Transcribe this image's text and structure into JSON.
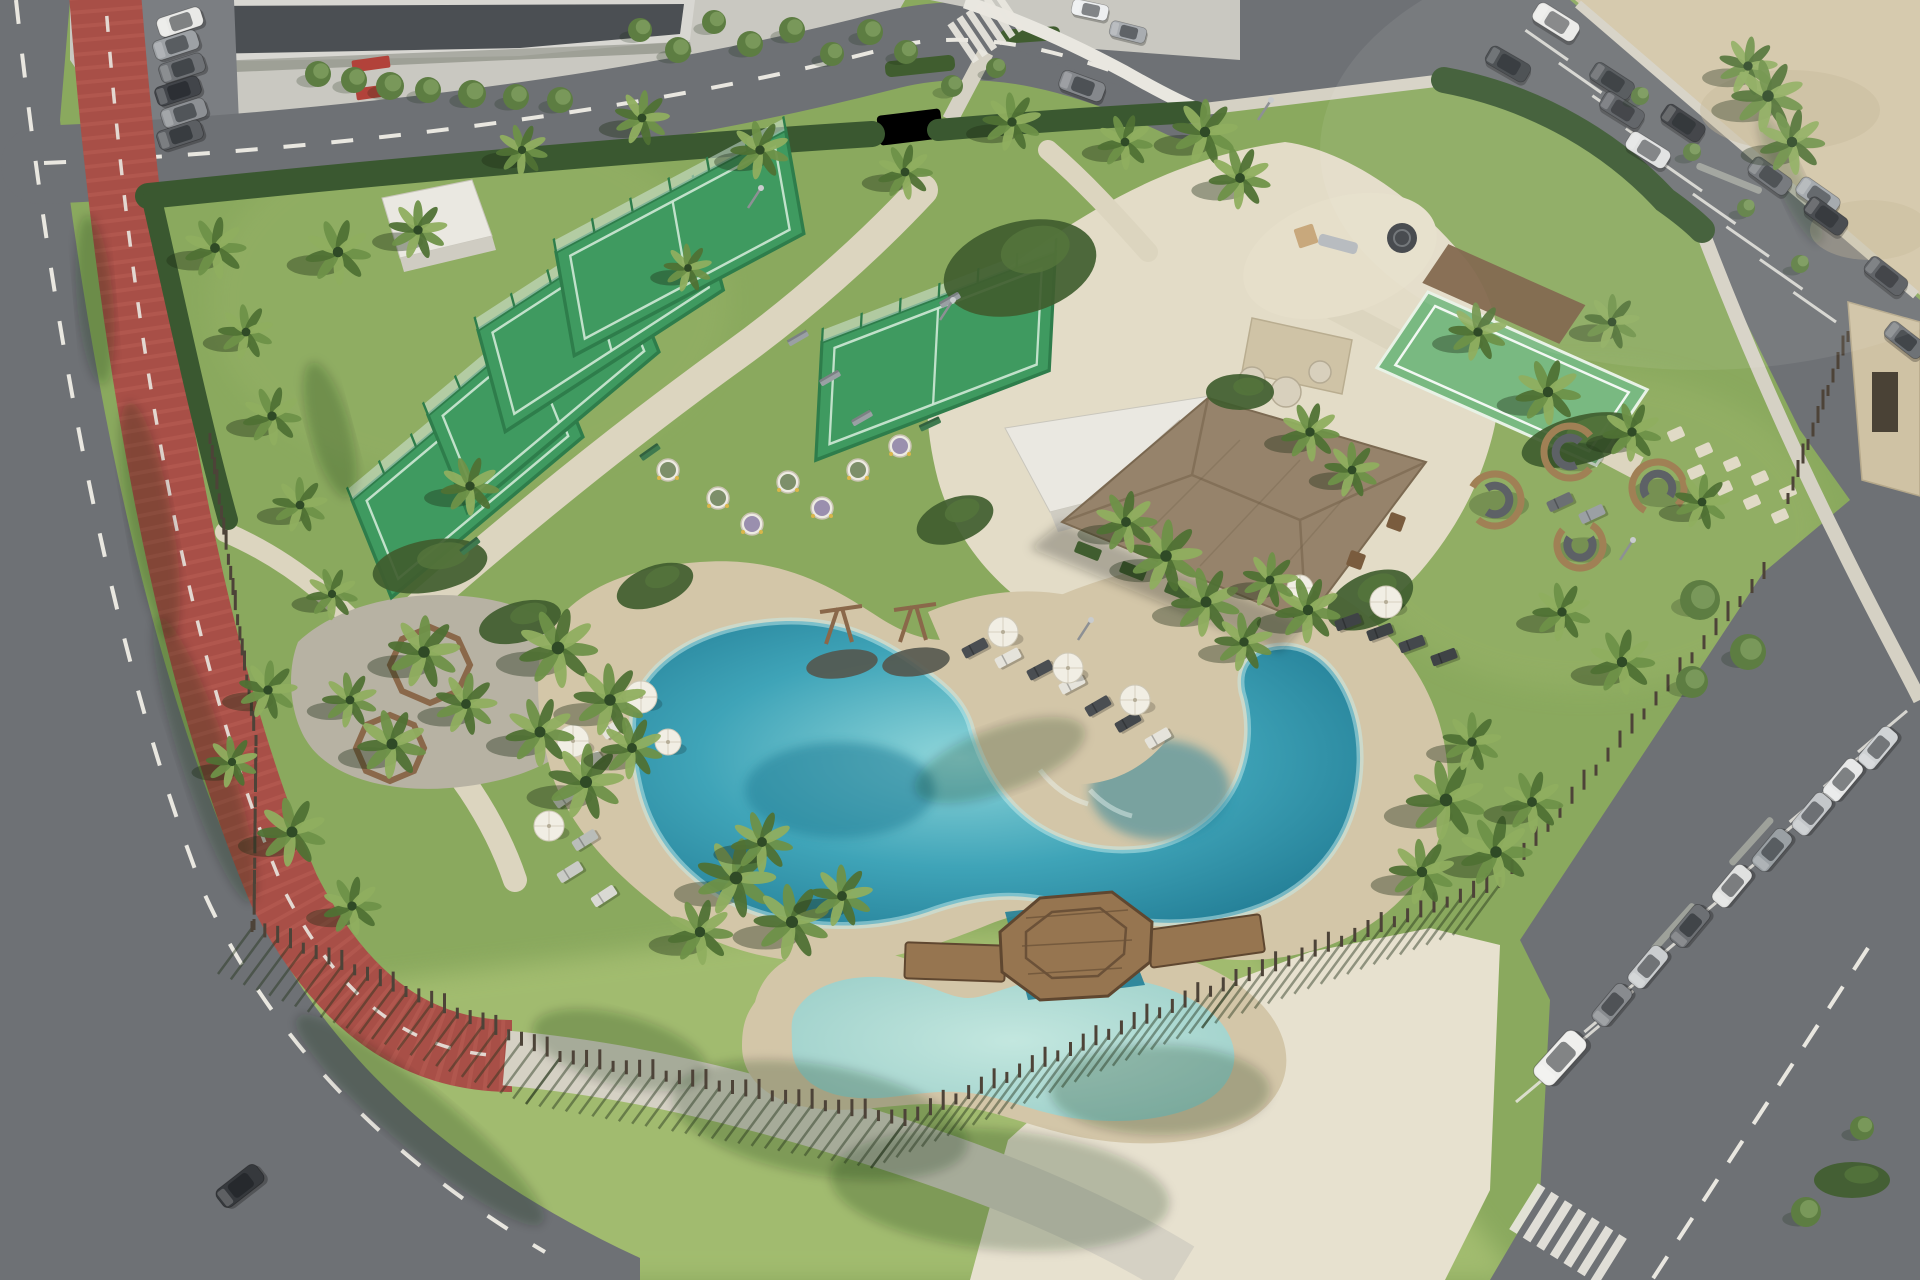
{
  "meta": {
    "title": "Aerial 3D render of a beachfront resort amenity park",
    "view": "oblique aerial / drone",
    "no_visible_text": true
  },
  "palette": {
    "grass": "#8aa95e",
    "grassLight": "#a6bf72",
    "grassPale": "#97b267",
    "road": "#6e7175",
    "roadLight": "#7b7e82",
    "roadDark": "#616468",
    "redPath": "#a84f47",
    "redPathLight": "#bd6157",
    "marking": "#e9e7e0",
    "walk": "#d5d1c4",
    "plazaTL": "#c9c8c1",
    "buildingDark": "#4b4f53",
    "buildingRoof": "#d8d7d2",
    "redAccent": "#b2423a",
    "sand": "#d3c6a8",
    "sandLight": "#e2d8bd",
    "pavement": "#dcd5bf",
    "plaza": "#e3dcc7",
    "plazaBR": "#e7e1cf",
    "gravel": "#b7b2a3",
    "hedge": "#3a5830",
    "bush": "#405d2f",
    "palmDark": "#2f4a26",
    "palm": "#4f7134",
    "palmLight": "#6e9148",
    "palmPale": "#8fae5f",
    "treeGreen": "#5d7d42",
    "treeLight": "#79985a",
    "courtTurf": "#3f9a60",
    "courtLine": "#cfe9d6",
    "cage": "#2e7d4b",
    "glass": "#d8ece4",
    "bocce": "#79b981",
    "canopy": "#7a5f43",
    "poolDeep": "#247f97",
    "pool": "#3fa4b8",
    "poolLight": "#8fd6da",
    "poolPale": "#c5ecec",
    "kidsPool": "#9ccfc9",
    "kidsPoolLight": "#c3e7df",
    "thatch": "#96836b",
    "thatchDark": "#7c6a52",
    "whiteBldg": "#eae8e1",
    "whiteBldgSide": "#cfccc2",
    "tanBldg": "#cfc2a4",
    "wood": "#8a684a",
    "woodDark": "#5f4730",
    "deck": "#967550",
    "fence": "#4d4338",
    "fenceShadow": "rgba(35,52,27,0.45)",
    "stoneWall": "#cfc3a6",
    "boulder": "#d8d0bd",
    "umbrella": "#f1eee4",
    "loungerWhite": "#e6e4dc",
    "loungerGray": "#9aa0a4",
    "loungerDark": "#44484c",
    "podWood": "#a08055",
    "podSofa": "#5d6166",
    "shadow": "rgba(30,45,22,0.38)",
    "shadowSoft": "rgba(25,40,20,0.22)"
  },
  "inventory": {
    "padel_courts": 5,
    "multisport_turf_courts": 1,
    "pools": 3,
    "cars_total": 30,
    "cars_parked": 28,
    "cars_moving": 2,
    "palm_trees": 58,
    "round_trees": 26,
    "sun_loungers": 20,
    "parasols": 9,
    "seating_pods": 4,
    "swing_frames": 2,
    "playgrounds": 1,
    "pavilions": 1,
    "picnic_planter_rings": 2,
    "crosswalks": 2
  },
  "scene": {
    "palms": [
      [
        215,
        248,
        0.9
      ],
      [
        246,
        332,
        0.8
      ],
      [
        272,
        416,
        0.85
      ],
      [
        300,
        505,
        0.8
      ],
      [
        332,
        594,
        0.75
      ],
      [
        268,
        690,
        0.85
      ],
      [
        292,
        832,
        1
      ],
      [
        352,
        906,
        0.85
      ],
      [
        232,
        762,
        0.75
      ],
      [
        338,
        252,
        0.95
      ],
      [
        418,
        230,
        0.85
      ],
      [
        522,
        150,
        0.75
      ],
      [
        642,
        118,
        0.8
      ],
      [
        760,
        150,
        0.85
      ],
      [
        905,
        172,
        0.8
      ],
      [
        1012,
        122,
        0.85
      ],
      [
        1125,
        142,
        0.8
      ],
      [
        1205,
        132,
        0.95
      ],
      [
        1240,
        178,
        0.9
      ],
      [
        1748,
        66,
        0.85
      ],
      [
        1768,
        96,
        1.05
      ],
      [
        1792,
        142,
        0.95
      ],
      [
        688,
        268,
        0.7
      ],
      [
        470,
        486,
        0.85
      ],
      [
        424,
        652,
        1.05
      ],
      [
        392,
        744,
        1
      ],
      [
        466,
        704,
        0.9
      ],
      [
        350,
        700,
        0.8
      ],
      [
        558,
        648,
        1.15
      ],
      [
        610,
        700,
        1.05
      ],
      [
        540,
        732,
        1
      ],
      [
        586,
        782,
        1.1
      ],
      [
        632,
        748,
        0.9
      ],
      [
        736,
        878,
        1.15
      ],
      [
        792,
        922,
        1.1
      ],
      [
        700,
        932,
        0.95
      ],
      [
        842,
        896,
        0.9
      ],
      [
        762,
        842,
        0.9
      ],
      [
        1166,
        556,
        1.05
      ],
      [
        1206,
        602,
        1
      ],
      [
        1126,
        522,
        0.9
      ],
      [
        1244,
        642,
        0.85
      ],
      [
        1310,
        432,
        0.85
      ],
      [
        1352,
        470,
        0.8
      ],
      [
        1308,
        610,
        0.95
      ],
      [
        1270,
        580,
        0.8
      ],
      [
        1446,
        800,
        1.15
      ],
      [
        1496,
        852,
        1.05
      ],
      [
        1422,
        872,
        0.95
      ],
      [
        1532,
        802,
        0.9
      ],
      [
        1472,
        742,
        0.85
      ],
      [
        1632,
        432,
        0.85
      ],
      [
        1702,
        502,
        0.8
      ],
      [
        1562,
        612,
        0.85
      ],
      [
        1622,
        662,
        0.95
      ],
      [
        1478,
        332,
        0.85
      ],
      [
        1548,
        392,
        0.95
      ],
      [
        1612,
        322,
        0.8
      ]
    ],
    "roundTrees": [
      [
        318,
        74,
        13
      ],
      [
        354,
        80,
        13
      ],
      [
        390,
        86,
        14
      ],
      [
        428,
        90,
        13
      ],
      [
        472,
        94,
        14
      ],
      [
        516,
        97,
        13
      ],
      [
        560,
        100,
        13
      ],
      [
        640,
        30,
        12
      ],
      [
        678,
        50,
        13
      ],
      [
        714,
        22,
        12
      ],
      [
        750,
        44,
        13
      ],
      [
        792,
        30,
        13
      ],
      [
        832,
        54,
        12
      ],
      [
        870,
        32,
        13
      ],
      [
        906,
        52,
        12
      ],
      [
        1640,
        96,
        9
      ],
      [
        1692,
        152,
        9
      ],
      [
        1746,
        208,
        9
      ],
      [
        1800,
        264,
        9
      ],
      [
        1700,
        600,
        20
      ],
      [
        1748,
        652,
        18
      ],
      [
        1692,
        682,
        16
      ],
      [
        1806,
        1212,
        15
      ],
      [
        1862,
        1128,
        12
      ],
      [
        952,
        86,
        11
      ],
      [
        996,
        68,
        10
      ]
    ],
    "cars": [
      [
        180,
        22,
        -18,
        "#e9e9e7",
        1
      ],
      [
        176,
        45,
        -18,
        "#9da1a5",
        1
      ],
      [
        182,
        68,
        -18,
        "#6f7276",
        1
      ],
      [
        178,
        91,
        -18,
        "#42454a",
        1
      ],
      [
        184,
        113,
        -18,
        "#8d9094",
        1
      ],
      [
        180,
        135,
        -18,
        "#5b5e62",
        1
      ],
      [
        1082,
        86,
        20,
        "#85888c",
        1
      ],
      [
        1090,
        10,
        12,
        "#edeff0",
        0.8
      ],
      [
        1128,
        32,
        14,
        "#a9adb1",
        0.8
      ],
      [
        1556,
        22,
        32,
        "#eaeae8",
        1.05
      ],
      [
        1508,
        64,
        30,
        "#42464a",
        1
      ],
      [
        1612,
        81,
        33,
        "#4e5256",
        1
      ],
      [
        1622,
        110,
        32,
        "#585b5f",
        1
      ],
      [
        1683,
        123,
        34,
        "#373a3e",
        1
      ],
      [
        1648,
        150,
        32,
        "#e0e1e1",
        1
      ],
      [
        1770,
        176,
        36,
        "#6e7276",
        1
      ],
      [
        1818,
        196,
        35,
        "#a0a5a9",
        1
      ],
      [
        1826,
        216,
        36,
        "#3d4044",
        1
      ],
      [
        1886,
        276,
        38,
        "#56595d",
        1
      ],
      [
        1905,
        340,
        38,
        "#6e7276",
        0.95
      ],
      [
        1878,
        748,
        -50,
        "#d0d3d5",
        1
      ],
      [
        1843,
        780,
        -50,
        "#e7e8e8",
        1
      ],
      [
        1812,
        814,
        -50,
        "#c4c7ca",
        1
      ],
      [
        1772,
        850,
        -50,
        "#9aa0a4",
        1
      ],
      [
        1732,
        886,
        -50,
        "#e0e1e0",
        1
      ],
      [
        1690,
        926,
        -50,
        "#6d7074",
        1
      ],
      [
        1648,
        967,
        -50,
        "#cacdcf",
        1
      ],
      [
        1612,
        1005,
        -50,
        "#888b8f",
        1
      ],
      [
        1560,
        1058,
        -48,
        "#efefed",
        1.3
      ],
      [
        240,
        1186,
        -38,
        "#36393d",
        1.1
      ]
    ],
    "loungers": [
      [
        614,
        728,
        -35,
        "#e5e3db"
      ],
      [
        590,
        762,
        -35,
        "#e5e3db"
      ],
      [
        566,
        797,
        -35,
        "#d9d9d3"
      ],
      [
        585,
        840,
        -32,
        "#b9bdb9"
      ],
      [
        570,
        872,
        -32,
        "#c9cbc6"
      ],
      [
        604,
        896,
        -33,
        "#d9d9d3"
      ],
      [
        975,
        648,
        -28,
        "#4a4e52"
      ],
      [
        1008,
        658,
        -28,
        "#e5e3db"
      ],
      [
        1040,
        670,
        -28,
        "#4a4e52"
      ],
      [
        1072,
        684,
        -28,
        "#e5e3db"
      ],
      [
        1098,
        706,
        -30,
        "#4a4e52"
      ],
      [
        1128,
        722,
        -30,
        "#44484c"
      ],
      [
        1158,
        738,
        -30,
        "#e5e3db"
      ],
      [
        1348,
        622,
        -20,
        "#3f4346"
      ],
      [
        1380,
        632,
        -20,
        "#3f4346"
      ],
      [
        1412,
        644,
        -20,
        "#44484c"
      ],
      [
        1444,
        657,
        -20,
        "#3f4346"
      ],
      [
        1560,
        502,
        -25,
        "#6b6f73"
      ],
      [
        1592,
        514,
        -25,
        "#9ba0a4"
      ],
      [
        628,
        700,
        -30,
        "#d9d9d3"
      ]
    ],
    "umbrellas": [
      [
        641,
        697,
        16
      ],
      [
        573,
        741,
        16
      ],
      [
        549,
        826,
        15
      ],
      [
        1003,
        632,
        15
      ],
      [
        1068,
        668,
        15
      ],
      [
        1135,
        700,
        15
      ],
      [
        1386,
        602,
        16
      ],
      [
        1300,
        588,
        13
      ],
      [
        668,
        742,
        13
      ]
    ],
    "pods": [
      [
        1570,
        452,
        26,
        40
      ],
      [
        1495,
        500,
        26,
        210
      ],
      [
        1658,
        488,
        26,
        120
      ],
      [
        1580,
        545,
        23,
        300
      ]
    ],
    "pots": [
      [
        718,
        498,
        "o"
      ],
      [
        752,
        524,
        "l"
      ],
      [
        788,
        482,
        "o"
      ],
      [
        822,
        508,
        "l"
      ],
      [
        858,
        470,
        "o"
      ],
      [
        900,
        446,
        "l"
      ],
      [
        668,
        470,
        "o"
      ]
    ],
    "benches": [
      [
        798,
        338,
        -30,
        "#9aa0a4"
      ],
      [
        830,
        378,
        -30,
        "#9aa0a4"
      ],
      [
        862,
        418,
        -30,
        "#9aa0a4"
      ],
      [
        950,
        300,
        -30,
        "#9aa0a4"
      ],
      [
        470,
        546,
        -38,
        "#3f7a4f"
      ],
      [
        650,
        452,
        -35,
        "#3f7a4f"
      ],
      [
        930,
        424,
        -25,
        "#3f7a4f"
      ]
    ],
    "fences": [
      [
        252,
        928,
        560,
        1058,
        24,
        1
      ],
      [
        560,
        1058,
        905,
        1122,
        26,
        1
      ],
      [
        905,
        1122,
        1236,
        982,
        26,
        1
      ],
      [
        1236,
        982,
        1500,
        884,
        20,
        1
      ],
      [
        1500,
        884,
        1764,
        575,
        22,
        0
      ],
      [
        1788,
        500,
        1848,
        338,
        12,
        0
      ],
      [
        210,
        440,
        256,
        742,
        20,
        0
      ],
      [
        256,
        742,
        254,
        926,
        12,
        0
      ]
    ],
    "stones": [
      [
        1676,
        434
      ],
      [
        1704,
        450
      ],
      [
        1732,
        464
      ],
      [
        1760,
        478
      ],
      [
        1788,
        492
      ],
      [
        1696,
        472
      ],
      [
        1724,
        488
      ],
      [
        1752,
        502
      ],
      [
        1780,
        516
      ]
    ],
    "bushes": [
      [
        1020,
        268,
        78,
        46,
        -15
      ],
      [
        430,
        566,
        58,
        26,
        -10
      ],
      [
        655,
        586,
        40,
        20,
        -20
      ],
      [
        1240,
        392,
        34,
        18,
        0
      ],
      [
        1580,
        440,
        60,
        24,
        -15
      ],
      [
        1370,
        600,
        46,
        26,
        -25
      ],
      [
        520,
        622,
        42,
        20,
        -15
      ],
      [
        1852,
        1180,
        38,
        18,
        0
      ],
      [
        955,
        520,
        40,
        22,
        -20
      ]
    ],
    "shadowBlobs": [
      [
        150,
        520,
        120,
        22,
        80
      ],
      [
        205,
        760,
        150,
        24,
        72
      ],
      [
        420,
        1120,
        160,
        30,
        40
      ],
      [
        95,
        300,
        85,
        18,
        85
      ],
      [
        820,
        1120,
        150,
        55,
        10
      ],
      [
        1000,
        1190,
        170,
        60,
        5
      ],
      [
        1160,
        1090,
        110,
        45,
        0
      ],
      [
        620,
        1050,
        90,
        35,
        15
      ],
      [
        1000,
        760,
        90,
        32,
        -20
      ],
      [
        330,
        430,
        70,
        20,
        75
      ],
      [
        1790,
        180,
        70,
        14,
        65
      ]
    ],
    "bayLines": [
      {
        "x1": 1568,
        "y1": 60,
        "x2": 1836,
        "y2": 322,
        "n": 8,
        "len": 52,
        "ang": 215
      },
      {
        "x1": 1516,
        "y1": 1102,
        "x2": 1858,
        "y2": 752,
        "n": 10,
        "len": 64,
        "ang": -40
      }
    ],
    "dividers": [
      {
        "x": 1698,
        "y": 162,
        "len": 70,
        "ang": 22
      },
      {
        "x": 1728,
        "y": 862,
        "len": 62,
        "ang": -48
      },
      {
        "x": 1650,
        "y": 948,
        "len": 62,
        "ang": -48
      }
    ],
    "zebras": [
      {
        "x": 986,
        "y": 27,
        "rot": -34,
        "n": 6,
        "w": 7,
        "h": 46,
        "gap": 11
      },
      {
        "x": 1568,
        "y": 1234,
        "rot": 32,
        "n": 7,
        "w": 9,
        "h": 54,
        "gap": 16
      }
    ],
    "courts": [
      {
        "x": 352,
        "y": 500,
        "rot": -40,
        "skew": -18,
        "w": 250,
        "h": 100,
        "kind": "padel"
      },
      {
        "x": 428,
        "y": 415,
        "rot": -40,
        "skew": -18,
        "w": 250,
        "h": 100,
        "kind": "padel"
      },
      {
        "x": 478,
        "y": 330,
        "rot": -33,
        "skew": -18,
        "w": 260,
        "h": 100,
        "kind": "padel"
      },
      {
        "x": 556,
        "y": 252,
        "rot": -28,
        "skew": -18,
        "w": 260,
        "h": 100,
        "kind": "padel"
      },
      {
        "x": 822,
        "y": 342,
        "rot": -21,
        "skew": -24,
        "w": 250,
        "h": 108,
        "kind": "padel"
      },
      {
        "x": 1428,
        "y": 292,
        "rot": 24,
        "skew": -10,
        "w": 240,
        "h": 90,
        "kind": "bocce"
      }
    ],
    "lightPoles": [
      [
        748,
        208
      ],
      [
        940,
        320
      ],
      [
        1258,
        120
      ],
      [
        1620,
        560
      ],
      [
        1078,
        640
      ]
    ]
  }
}
